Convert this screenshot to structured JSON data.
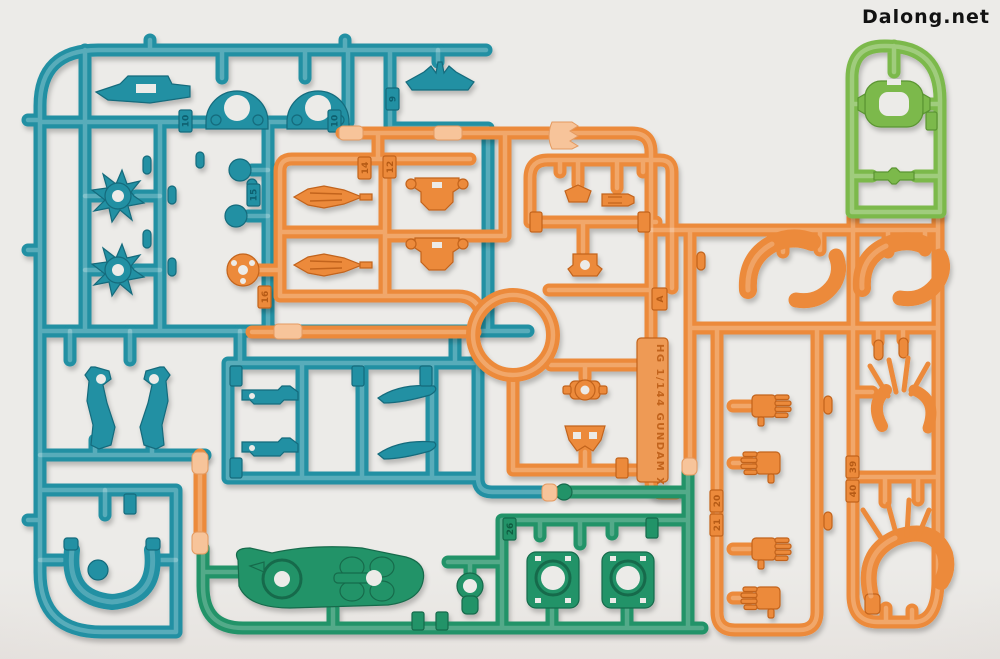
{
  "watermark": {
    "text": "Dalong.net"
  },
  "scene": {
    "description": "Photograph of four injection-molded plastic model kit runner sprues (parts trees) laid flat on a neutral light background",
    "colors": {
      "background": "#ecebe8",
      "teal": "#2090a3",
      "orange": "#ec8a3a",
      "light_green": "#7cb94c",
      "dark_green": "#239368",
      "gate_clip": "#f7c49a"
    },
    "embossed": {
      "kit_text": "HG 1/144 GUNDAM X",
      "runner_letter": "A"
    },
    "part_number_tags": [
      {
        "label": "9"
      },
      {
        "label": "10"
      },
      {
        "label": "10"
      },
      {
        "label": "15"
      },
      {
        "label": "12"
      },
      {
        "label": "14"
      },
      {
        "label": "16"
      },
      {
        "label": "20"
      },
      {
        "label": "21"
      },
      {
        "label": "26"
      },
      {
        "label": "39"
      },
      {
        "label": "40"
      }
    ],
    "visible_parts": [
      {
        "name": "arch-clamp",
        "color": "teal",
        "count": 2
      },
      {
        "name": "antenna-vent",
        "color": "teal",
        "count": 1
      },
      {
        "name": "hull-plate",
        "color": "teal",
        "count": 1
      },
      {
        "name": "spiked-joint-hub",
        "color": "teal",
        "count": 2
      },
      {
        "name": "ball-joint-sphere",
        "color": "teal",
        "count": 2
      },
      {
        "name": "weapon-half",
        "color": "teal",
        "count": 2
      },
      {
        "name": "fin-blade",
        "color": "teal",
        "count": 2
      },
      {
        "name": "leg-frame",
        "color": "teal",
        "count": 2
      },
      {
        "name": "curved-yoke",
        "color": "teal",
        "count": 1
      },
      {
        "name": "missile-spindle",
        "color": "orange",
        "count": 2
      },
      {
        "name": "torso-block",
        "color": "orange",
        "count": 2
      },
      {
        "name": "holed-disc",
        "color": "orange",
        "count": 1
      },
      {
        "name": "neck-joint",
        "color": "orange",
        "count": 1
      },
      {
        "name": "collar-joint",
        "color": "orange",
        "count": 1
      },
      {
        "name": "chest-vest",
        "color": "orange",
        "count": 1
      },
      {
        "name": "shoulder-armor-shell",
        "color": "orange",
        "count": 4
      },
      {
        "name": "hand-manipulator",
        "color": "orange",
        "count": 4
      },
      {
        "name": "spiked-thruster-fan",
        "color": "orange",
        "count": 1
      },
      {
        "name": "spiked-crown-armor",
        "color": "orange",
        "count": 1
      },
      {
        "name": "eye-ring",
        "color": "light_green",
        "count": 1
      },
      {
        "name": "engine-block",
        "color": "dark_green",
        "count": 1
      },
      {
        "name": "geared-joint",
        "color": "dark_green",
        "count": 2
      },
      {
        "name": "ring-joint",
        "color": "dark_green",
        "count": 1
      }
    ]
  }
}
